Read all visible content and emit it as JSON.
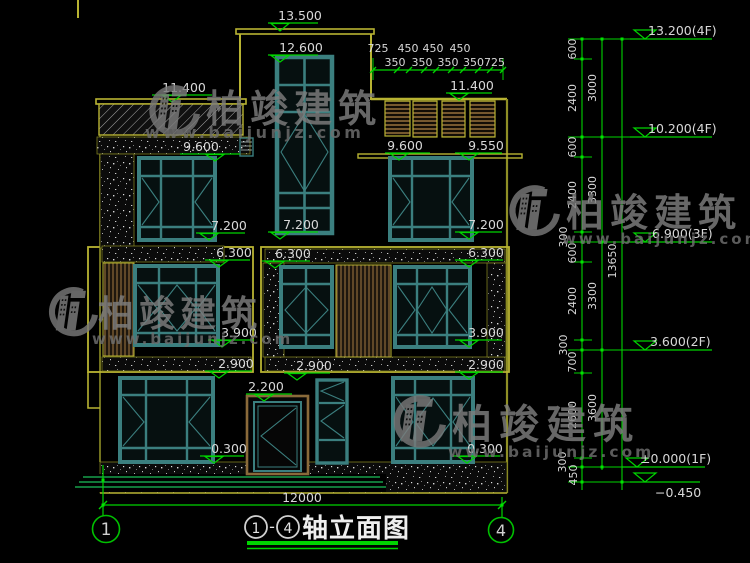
{
  "fl": {
    "v13_500": "13.500",
    "v12_600": "12.600",
    "v11_400": "11.400",
    "v9_600": "9.600",
    "v9_550": "9.550",
    "v7_200": "7.200",
    "v6_300": "6.300",
    "v3_900": "3.900",
    "v2_900": "2.900",
    "v2_200": "2.200",
    "v0_300": "0.300"
  },
  "top_dims": {
    "row1": [
      "725",
      "450",
      "450",
      "450"
    ],
    "row2": [
      "350",
      "350",
      "350",
      "350725"
    ]
  },
  "chain": {
    "levels": [
      "13.200(4F)",
      "10.200(4F)",
      "6.900(3F)",
      "3.600(2F)",
      "±0.000(1F)",
      "−0.450"
    ],
    "inner": [
      "600",
      "2400",
      "600",
      "2400",
      "300",
      "600",
      "2400",
      "300",
      "700",
      "2600",
      "300",
      "450"
    ],
    "mid": [
      "3000",
      "3300",
      "3300",
      "3600"
    ],
    "total": "13650"
  },
  "bottom": {
    "overall_width": "12000",
    "axis_left": "1",
    "axis_right": "4"
  },
  "title": {
    "c1": "1",
    "dash": "-",
    "c4": "4",
    "name": "轴立面图"
  },
  "watermark": {
    "cn": "柏竣建筑",
    "url": "www.baijunjz.com"
  },
  "colors": {
    "dim_green": "#00d400",
    "frame_teal": "#3b7f7f",
    "outline_yellow": "#b8b332",
    "wood_brown": "#8a6a3a",
    "text_white": "#d8d8d8",
    "watermark_gray": "#7e7e7e",
    "background": "#000000"
  }
}
